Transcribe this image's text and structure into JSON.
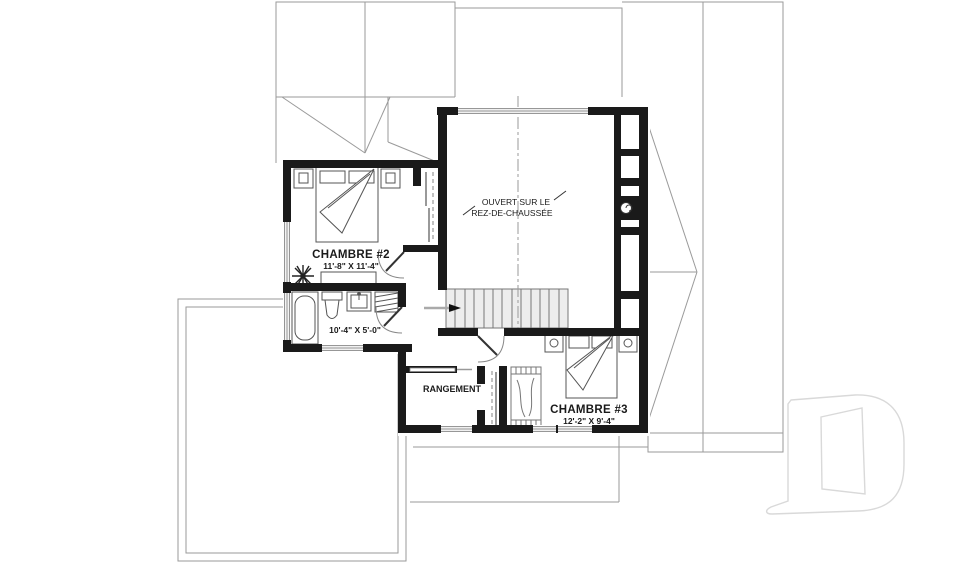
{
  "plan": {
    "title": "Second floor plan (étage)",
    "rooms": {
      "chambre2": {
        "name": "CHAMBRE #2",
        "dims": "11'-8\" X 11'-4\""
      },
      "bathroom": {
        "dims": "10'-4\" X 5'-0\""
      },
      "rangement": {
        "name": "RANGEMENT"
      },
      "chambre3": {
        "name": "CHAMBRE #3",
        "dims": "12'-2\" X 9'-4\""
      },
      "open_to_below": {
        "line1": "OUVERT SUR LE",
        "line2": "REZ-DE-CHAUSSÉE"
      }
    },
    "watermark": "D",
    "icons": {
      "ceiling_fan": "ceiling-fan-icon",
      "bathtub": "bathtub-icon",
      "toilet": "toilet-icon",
      "sink": "sink-icon",
      "beds": "bed-icon",
      "stairs_arrow": "stairs-direction-arrow",
      "chimney_flue": "chimney-flue-icon",
      "closet_rod": "closet-rod-dashed"
    },
    "colors": {
      "wall": "#1a1a1a",
      "roof_line": "#9a9a9a",
      "stairs_fill": "#ededed",
      "watermark": "#d9d9d9"
    }
  }
}
